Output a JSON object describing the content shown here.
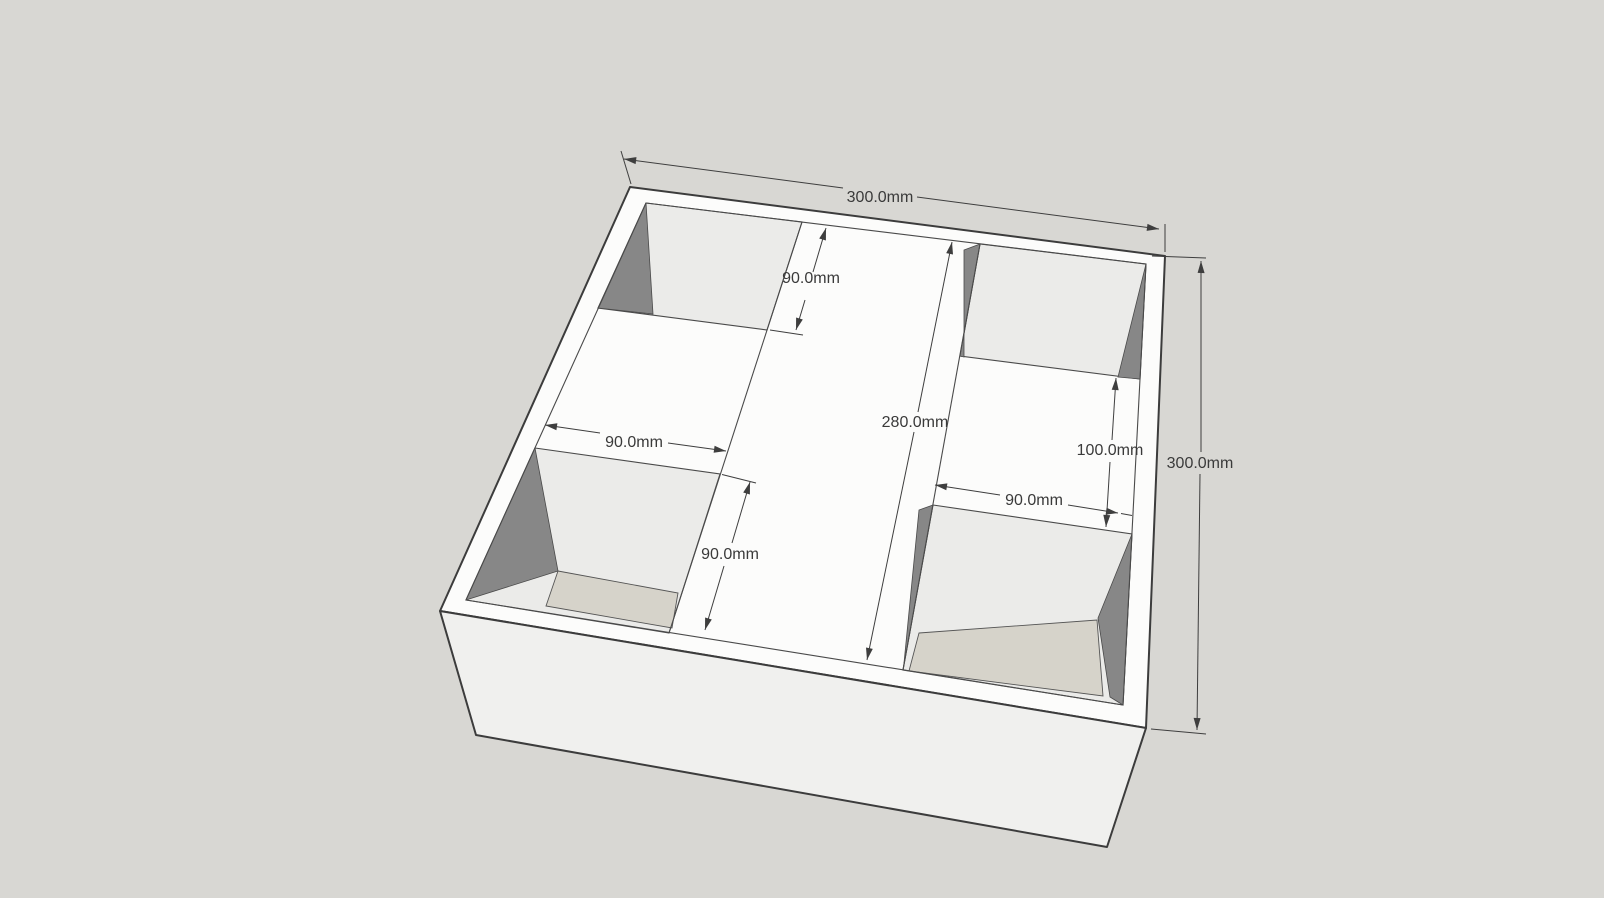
{
  "app": {
    "name": "3d-model-viewport",
    "description": "SketchUp-style perspective view of a square tray (300mm x 300mm) with four corner pockets, a raised center strip and dimension annotations"
  },
  "canvas": {
    "background": "#d8d7d3"
  },
  "model": {
    "object": "square-tray-with-corner-pockets",
    "colors": {
      "top_surface": "#fcfcfb",
      "front_face": "#f0f0ee",
      "pocket_wall_light": "#ebebe9",
      "pocket_wall_dark": "#878787",
      "pocket_floor": "#d6d3ca",
      "edge": "#3c3c3c",
      "dimension": "#3e3e3e"
    }
  },
  "dimensions": [
    {
      "id": "overall-width-top",
      "label": "300.0mm"
    },
    {
      "id": "back-pocket-depth",
      "label": "90.0mm"
    },
    {
      "id": "interior-length",
      "label": "280.0mm"
    },
    {
      "id": "right-pocket-gap",
      "label": "100.0mm"
    },
    {
      "id": "overall-depth-right",
      "label": "300.0mm"
    },
    {
      "id": "right-pocket-width",
      "label": "90.0mm"
    },
    {
      "id": "left-pocket-width",
      "label": "90.0mm"
    },
    {
      "id": "front-left-pocket-depth",
      "label": "90.0mm"
    }
  ]
}
